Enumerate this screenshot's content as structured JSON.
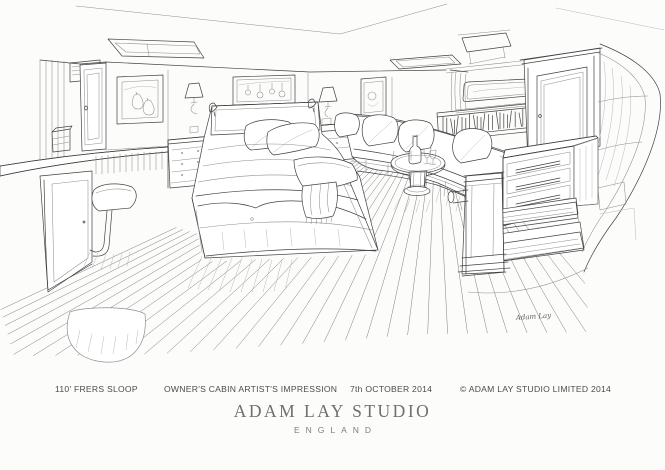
{
  "page": {
    "background": "#fcfcfb",
    "ink": "#424242",
    "light_ink": "#8f8f8f"
  },
  "captions": {
    "items": [
      "110' FRERS SLOOP",
      "OWNER'S CABIN ARTIST'S IMPRESSION",
      "7th OCTOBER 2014",
      "© ADAM LAY STUDIO LIMITED 2014"
    ]
  },
  "studio": {
    "name": "ADAM LAY STUDIO",
    "location": "ENGLAND"
  },
  "signature": "Adam Lay"
}
